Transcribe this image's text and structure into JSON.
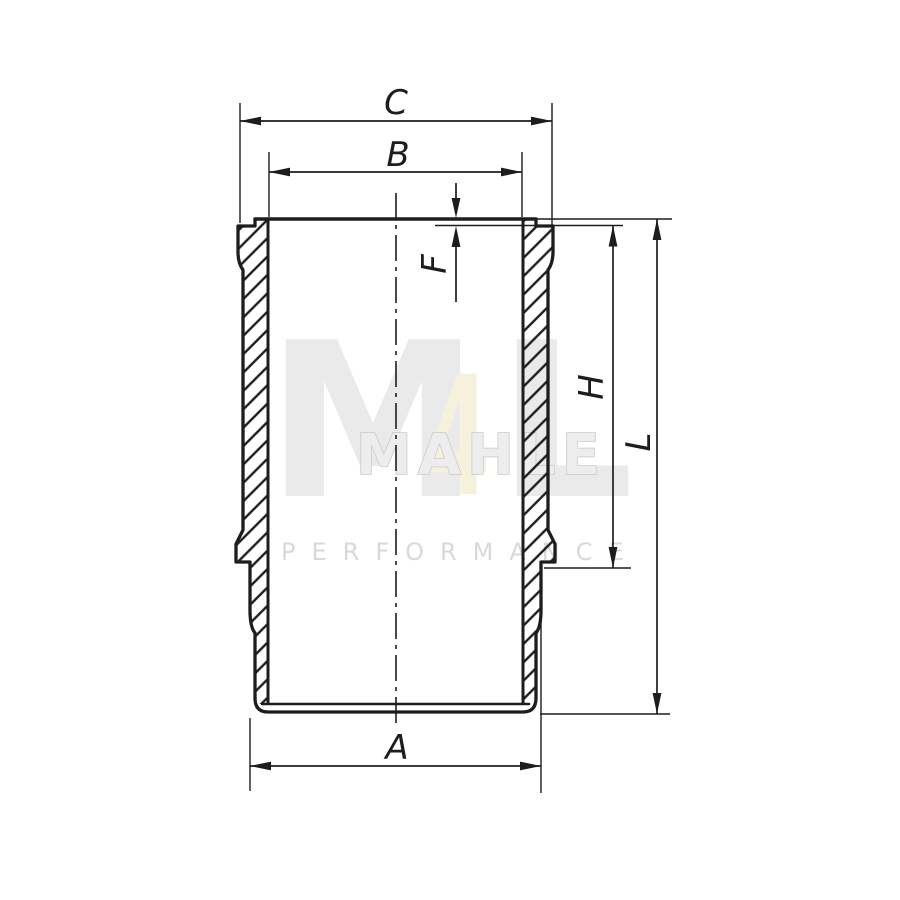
{
  "drawing": {
    "labels": {
      "c": "C",
      "b": "B",
      "f": "F",
      "h": "H",
      "l": "L",
      "a": "A"
    }
  },
  "watermark": {
    "big_m": "M",
    "big_4": "4",
    "big_l": "L",
    "logo_row": "MAHLE",
    "performance": "PERFORMANCE"
  },
  "colors": {
    "line": "#1d1d1d",
    "background": "#ffffff",
    "watermark_gray": "#eaeaea",
    "watermark_fill_gray": "#ededed",
    "watermark_outline_gray": "#c9c9c9",
    "watermark_pale_yellow": "#f6f1dd",
    "performance_gray": "#d9d9d9"
  }
}
